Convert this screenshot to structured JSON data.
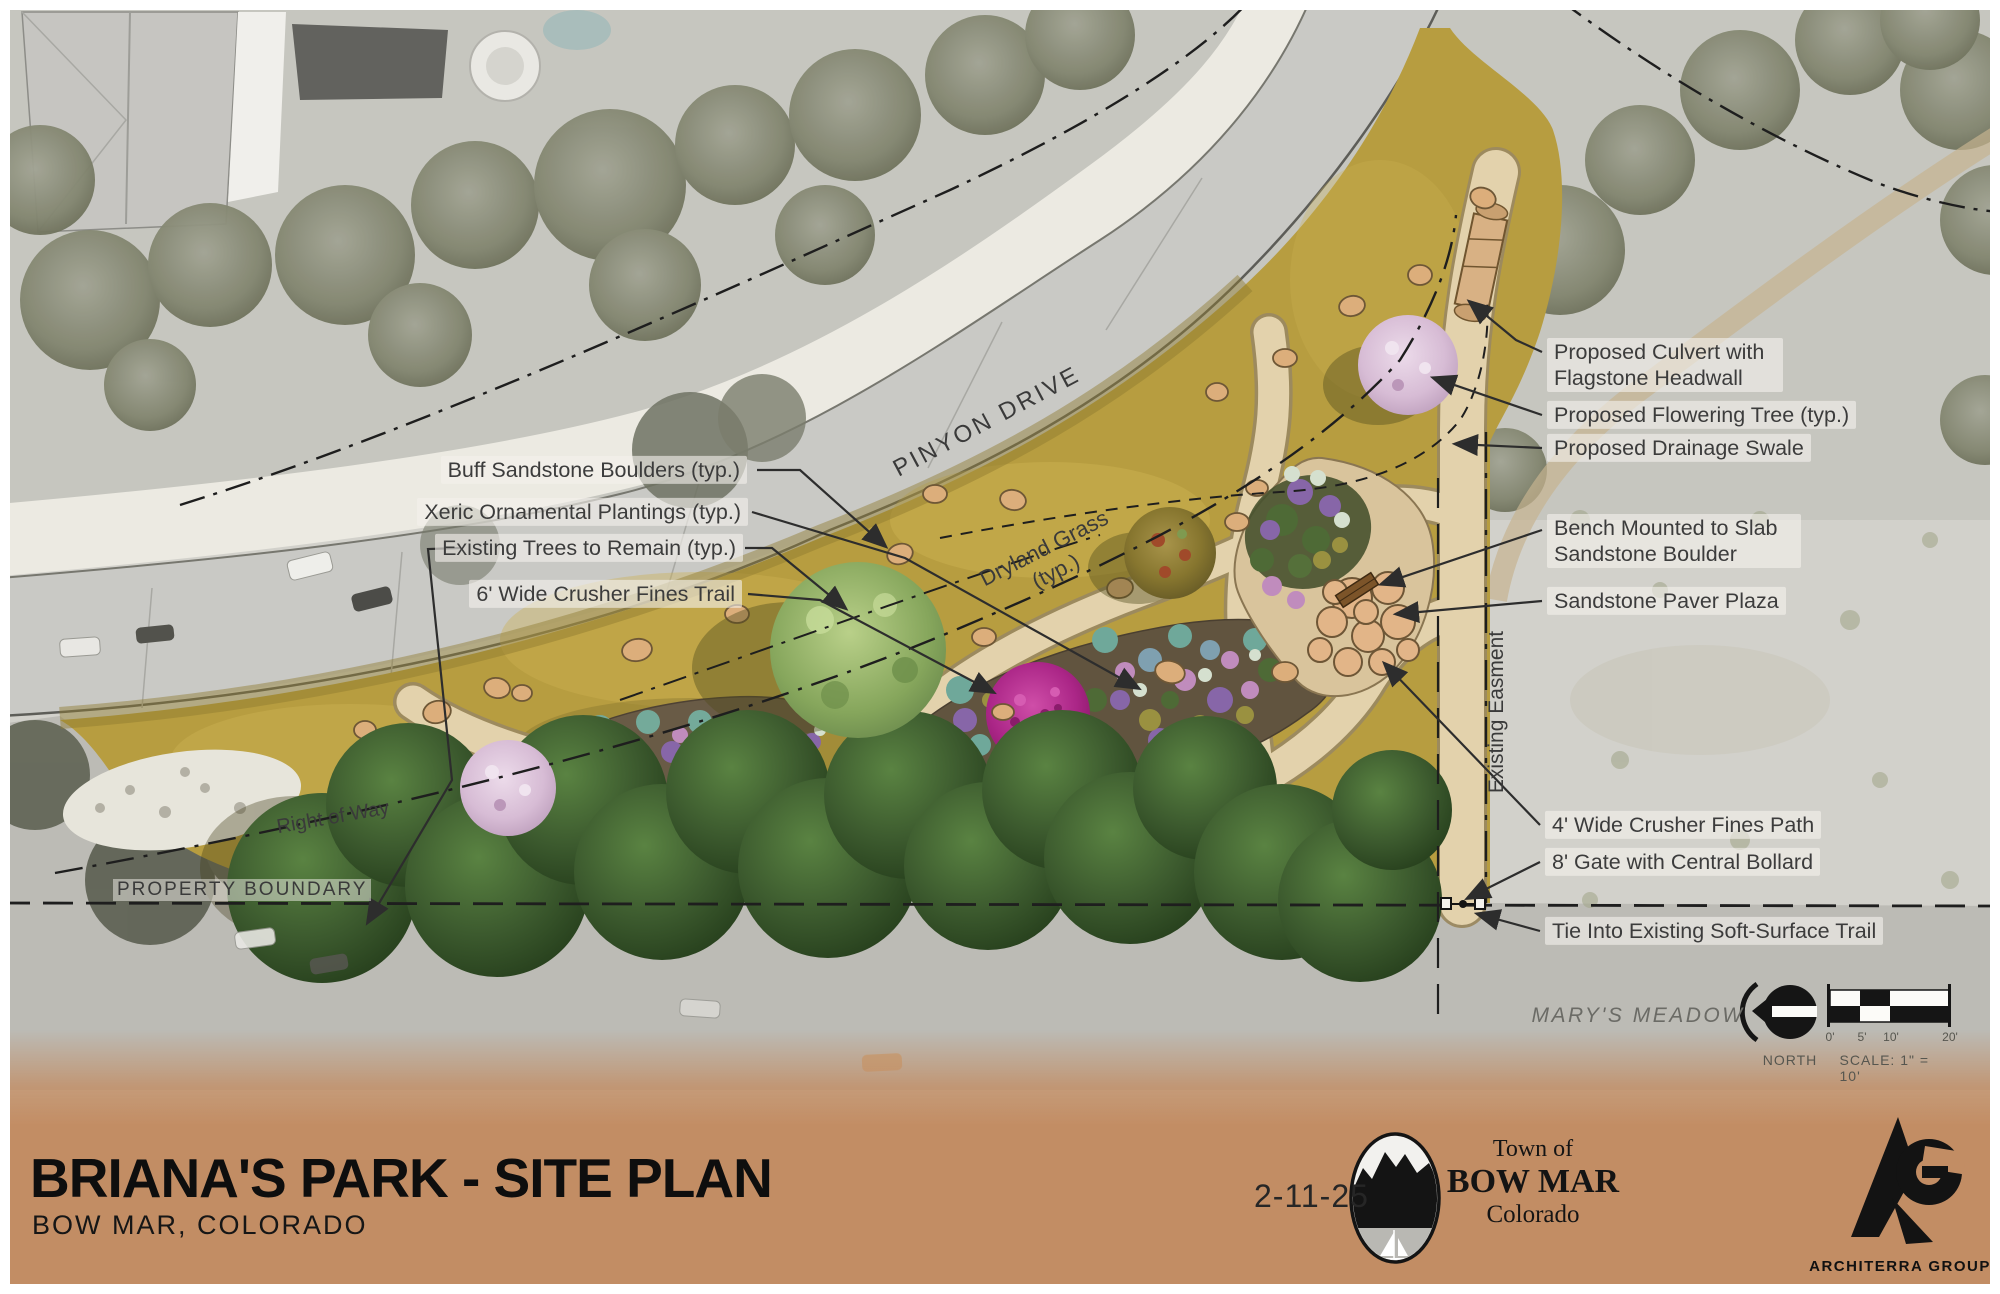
{
  "title_block": {
    "title": "BRIANA'S PARK - SITE PLAN",
    "subtitle": "BOW MAR, COLORADO",
    "date": "2-11-25",
    "band_color": "#c28d64"
  },
  "town_logo": {
    "line1": "Town of",
    "name": "BOW MAR",
    "state": "Colorado"
  },
  "firm": {
    "name": "ARCHITERRA GROUP"
  },
  "legend": {
    "north_label": "NORTH",
    "scale_label": "SCALE: 1\" = 10'",
    "ticks": [
      "0'",
      "5'",
      "10'",
      "20'"
    ]
  },
  "map_labels": {
    "street": "PINYON DRIVE",
    "grass_line1": "Dryland Grass",
    "grass_line2": "(typ.)",
    "right_of_way": "Right of Way",
    "property_boundary": "PROPERTY BOUNDARY",
    "easement": "Existing Easment",
    "meadow": "MARY'S MEADOW"
  },
  "callouts_left": [
    {
      "text": "Buff Sandstone Boulders (typ.)"
    },
    {
      "text": "Xeric Ornamental Plantings (typ.)"
    },
    {
      "text": "Existing Trees to Remain (typ.)"
    },
    {
      "text": "6' Wide Crusher Fines Trail"
    }
  ],
  "callouts_right": [
    {
      "text": "Proposed Culvert with Flagstone Headwall"
    },
    {
      "text": "Proposed Flowering Tree (typ.)"
    },
    {
      "text": "Proposed Drainage Swale"
    },
    {
      "text": "Bench Mounted to Slab Sandstone Boulder"
    },
    {
      "text": "Sandstone Paver Plaza"
    },
    {
      "text": "4' Wide Crusher Fines Path"
    },
    {
      "text": "8' Gate with Central Bollard"
    },
    {
      "text": "Tie Into Existing Soft-Surface Trail"
    }
  ],
  "colors": {
    "footer_band": "#c28d64",
    "dryland_grass": "#b79d40",
    "trail": "#e3d2ac",
    "road": "#c9c9c5",
    "evergreen": "#3a5330",
    "magenta_tree": "#b32b90",
    "flowering_tree": "#dcc2da",
    "boulder": "#dcae7b"
  }
}
